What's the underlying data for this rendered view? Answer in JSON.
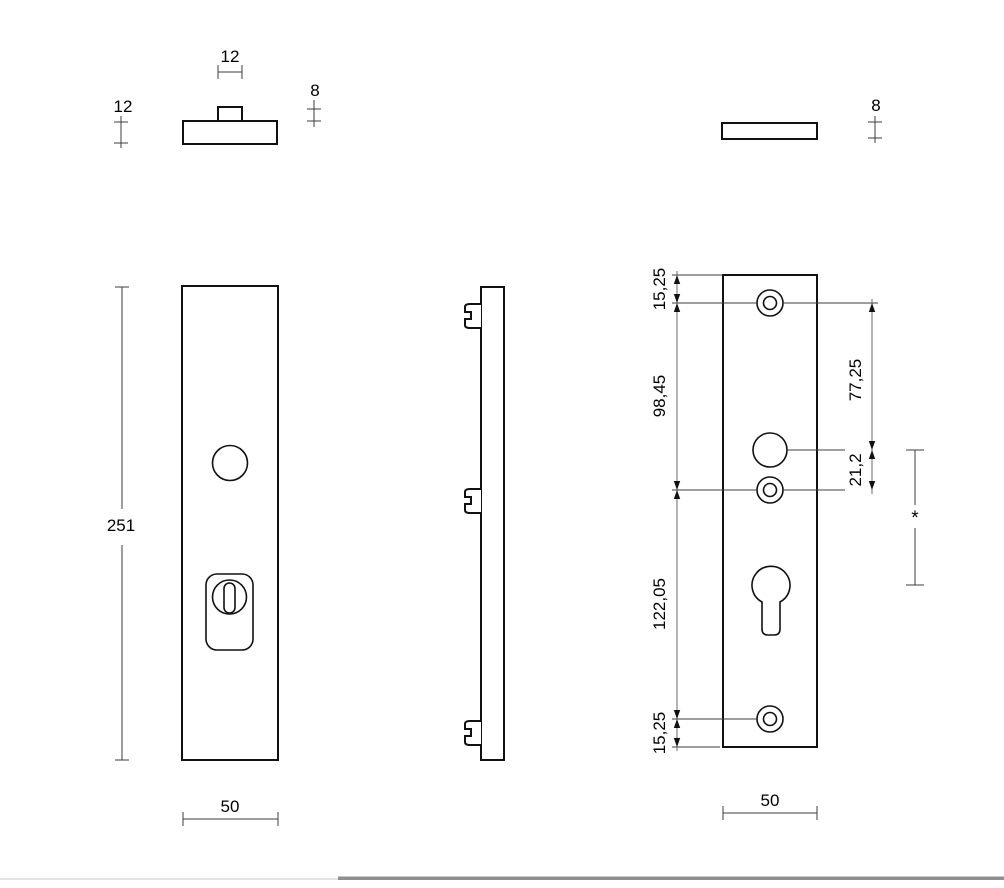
{
  "drawing_type": "technical-drawing-door-security-plate",
  "views": {
    "top_view_security_plate": {
      "boss_width": "12",
      "plate_thickness": "12",
      "boss_height": "8"
    },
    "top_view_flat_plate": {
      "plate_thickness": "8"
    },
    "front_view": {
      "plate_height": "251",
      "plate_width": "50"
    },
    "back_view": {
      "top_edge_to_top_hole": "15,25",
      "top_hole_to_middle_hole": "98,45",
      "middle_hole_to_bottom_hole": "122,05",
      "bottom_hole_to_bottom_edge": "15,25",
      "top_hole_to_handle_hole": "77,25",
      "handle_hole_to_middle_hole": "21,2",
      "plate_width": "50",
      "variable_dimension": "*"
    }
  }
}
